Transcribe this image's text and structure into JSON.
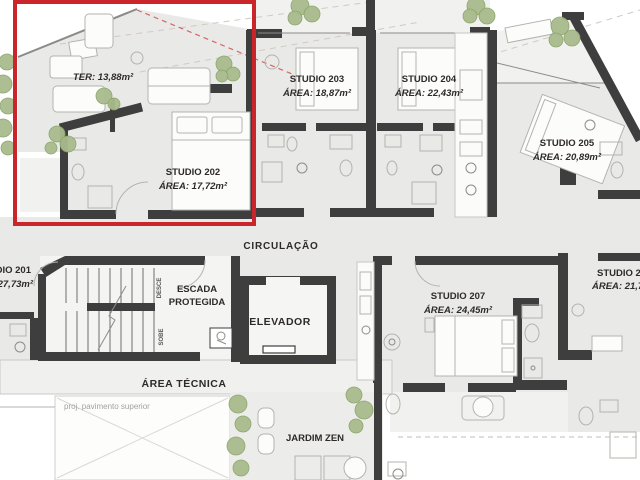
{
  "colors": {
    "highlight_red": "#c9252b",
    "wall_dark": "#3e3e3e",
    "floor_gray": "#e9e9e7",
    "plant_green": "#a9bc8d"
  },
  "units": {
    "studio201": {
      "name": "STUDIO 201",
      "area": "ÁREA: 27,73m²"
    },
    "studio202": {
      "name": "STUDIO 202",
      "area": "ÁREA: 17,72m²",
      "terrace": "TER: 13,88m²",
      "highlighted": true
    },
    "studio203": {
      "name": "STUDIO 203",
      "area": "ÁREA: 18,87m²"
    },
    "studio204": {
      "name": "STUDIO 204",
      "area": "ÁREA: 22,43m²"
    },
    "studio205": {
      "name": "STUDIO 205",
      "area": "ÁREA: 20,89m²"
    },
    "studio206": {
      "name": "STUDIO 206",
      "area": "ÁREA: 21,7m²"
    },
    "studio207": {
      "name": "STUDIO 207",
      "area": "ÁREA: 24,45m²"
    }
  },
  "common": {
    "circulation": "CIRCULAÇÃO",
    "stair_line1": "ESCADA",
    "stair_line2": "PROTEGIDA",
    "elevator": "ELEVADOR",
    "technical_area": "ÁREA TÉCNICA",
    "zen_garden": "JARDIM ZEN",
    "upper_floor_projection": "proj. pavimento superior",
    "stair_down": "DESCE",
    "stair_up": "SOBE"
  }
}
